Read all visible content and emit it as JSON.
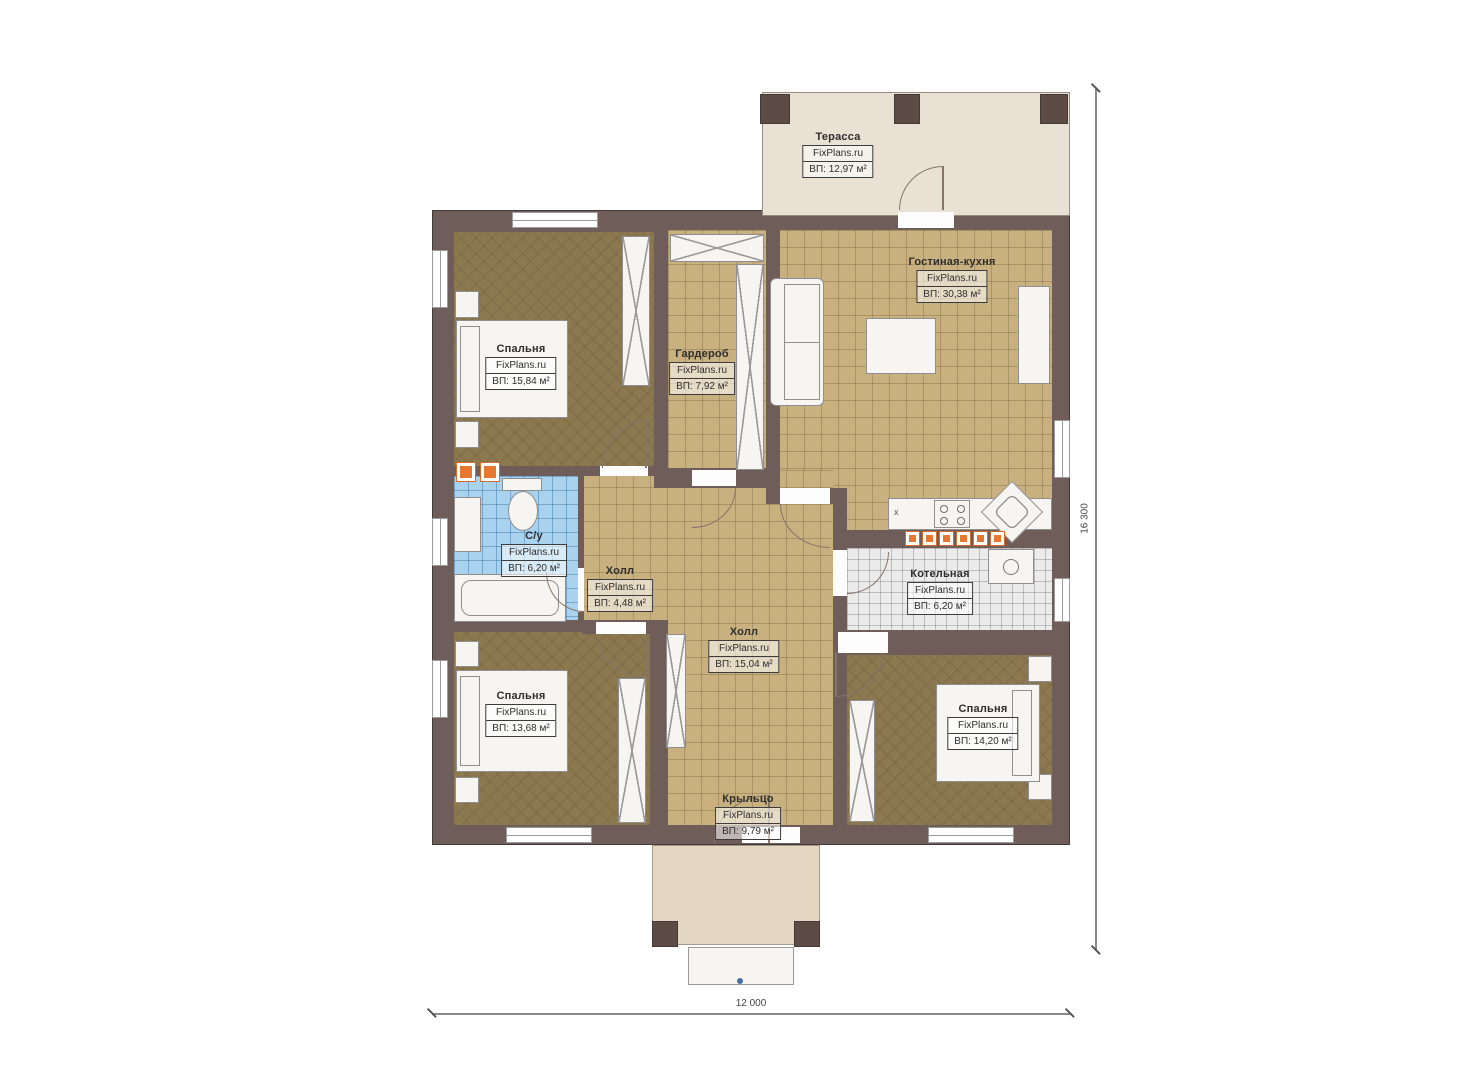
{
  "rooms": {
    "terrace": {
      "name": "Терасса",
      "watermark": "FixPlans.ru",
      "area": "ВП: 12,97 м²"
    },
    "living_kitchen": {
      "name": "Гостиная-кухня",
      "watermark": "FixPlans.ru",
      "area": "ВП: 30,38 м²"
    },
    "bedroom_top": {
      "name": "Спальня",
      "watermark": "FixPlans.ru",
      "area": "ВП: 15,84 м²"
    },
    "wardrobe": {
      "name": "Гардероб",
      "watermark": "FixPlans.ru",
      "area": "ВП: 7,92 м²"
    },
    "bathroom": {
      "name": "С/у",
      "watermark": "FixPlans.ru",
      "area": "ВП: 6,20 м²"
    },
    "hall_small": {
      "name": "Холл",
      "watermark": "FixPlans.ru",
      "area": "ВП: 4,48 м²"
    },
    "hall_main": {
      "name": "Холл",
      "watermark": "FixPlans.ru",
      "area": "ВП: 15,04 м²"
    },
    "boiler": {
      "name": "Котельная",
      "watermark": "FixPlans.ru",
      "area": "ВП: 6,20 м²"
    },
    "bedroom_left": {
      "name": "Спальня",
      "watermark": "FixPlans.ru",
      "area": "ВП: 13,68 м²"
    },
    "bedroom_right": {
      "name": "Спальня",
      "watermark": "FixPlans.ru",
      "area": "ВП: 14,20 м²"
    },
    "porch": {
      "name": "Крыльцо",
      "watermark": "FixPlans.ru",
      "area": "ВП: 9,79 м²"
    }
  },
  "dimensions": {
    "width_label": "12 000",
    "height_label": "16 300"
  },
  "kitchen": {
    "hob_mark": "х"
  },
  "colors": {
    "wall": "#6f5d5a",
    "tile_floor": "#c8b07f",
    "bedroom_floor": "#8d7950",
    "bathroom_tile": "#a9d2ee",
    "boiler_tile": "#ebebeb",
    "terrace_floor": "#e9e1d3",
    "porch_floor": "#e4d7c1",
    "vent_accent": "#e8762e"
  }
}
